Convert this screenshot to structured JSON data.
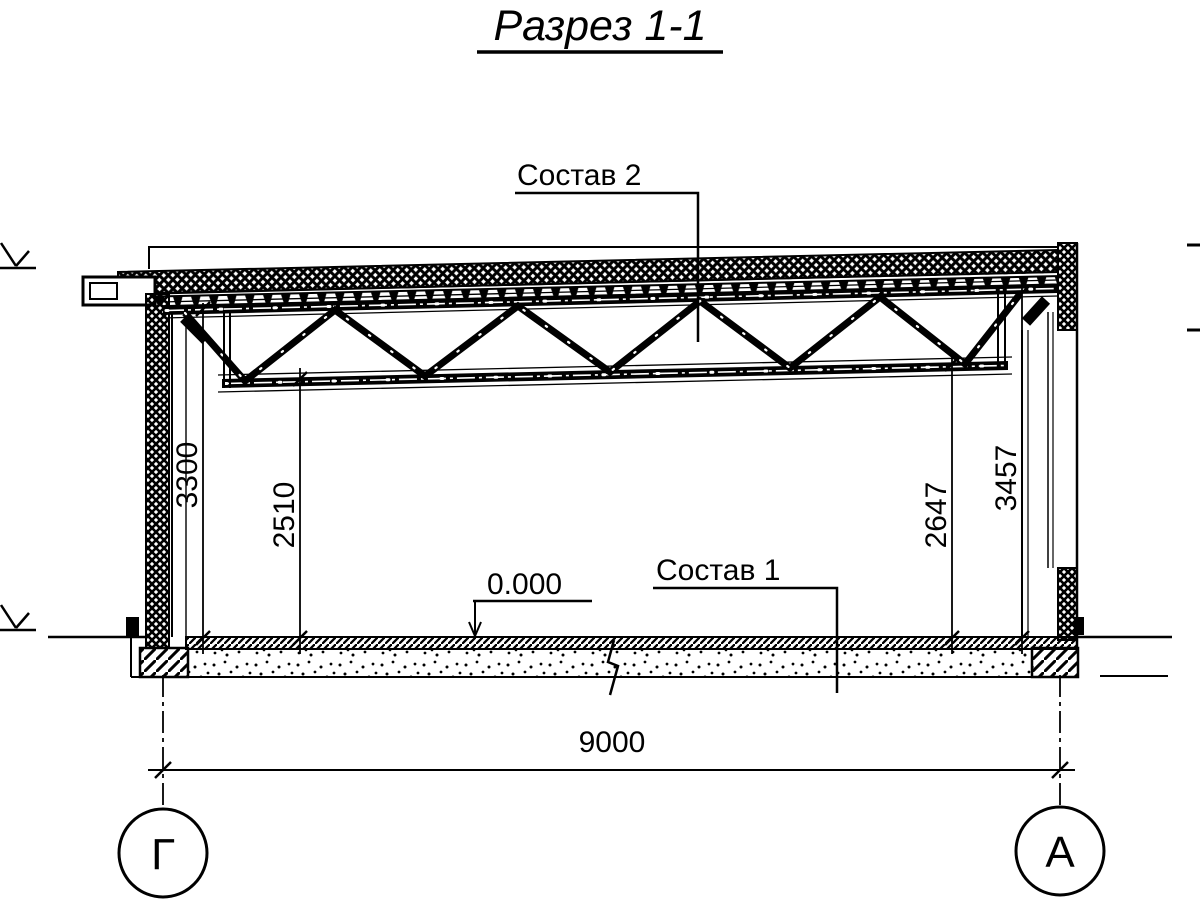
{
  "title": "Разрез 1-1",
  "callouts": {
    "roof": "Состав 2",
    "floor": "Состав 1"
  },
  "elevation": {
    "zero": "0.000"
  },
  "dimensions": {
    "left_wall_height": "3300",
    "left_truss_clearance": "2510",
    "right_truss_clearance": "2647",
    "right_wall_height": "3457",
    "span": "9000"
  },
  "axes": {
    "left_label": "Г",
    "right_label": "А"
  },
  "colors": {
    "ink": "#000000",
    "paper": "#ffffff"
  }
}
